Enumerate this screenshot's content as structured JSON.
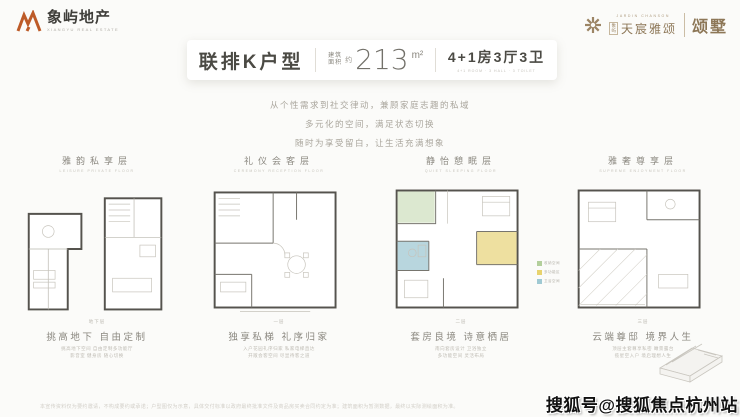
{
  "colors": {
    "brand_orange": "#bd5b28",
    "brand_gold": "#9c8565",
    "legend_green": "#b3cf9c",
    "legend_yellow": "#e8d36e",
    "legend_cyan": "#9fc9d3"
  },
  "header": {
    "left_brand": "象屿地产",
    "left_brand_en": "XIANGYU REAL ESTATE",
    "right_project_en": "JARDIN CHANSON",
    "right_prefix_1": "象",
    "right_prefix_2": "屿",
    "right_project": "天宸雅颂",
    "right_suffix": "颂墅"
  },
  "title_card": {
    "type_label": "联排K户型",
    "area_label_1": "建筑",
    "area_label_2": "面积",
    "area_approx": "约",
    "area_value": "213",
    "area_unit": "m²",
    "rooms": "4+1房3厅3卫",
    "rooms_en": "4+1 ROOM · 3 HALL · 3 TOILET"
  },
  "intro": {
    "line1": "从个性需求到社交律动，兼顾家庭志趣的私域",
    "line2": "多元化的空间，满足状态切换",
    "line3": "随时为享受留白，让生活充满想象"
  },
  "plans": [
    {
      "label": "雅韵私享层",
      "label_en": "LEISURE PRIVATE FLOOR",
      "floor_tag": "地下层",
      "caption": "挑高地下 自由定制",
      "note1": "挑高地下空间 自由定制多功能厅",
      "note2": "影音室 健身房 随心切换"
    },
    {
      "label": "礼仪会客层",
      "label_en": "CEREMONY RECEPTION FLOOR",
      "floor_tag": "一层",
      "caption": "独享私梯 礼序归家",
      "note1": "入户花园礼序归家 私家电梯直达",
      "note2": "开敞会客空间 尽显待客之道"
    },
    {
      "label": "静怡憩眠层",
      "label_en": "QUIET SLEEPING FLOOR",
      "floor_tag": "二层",
      "caption": "套房良境 诗意栖居",
      "note1": "南向套房设计 卫浴独立",
      "note2": "多功能空间 灵活布局"
    },
    {
      "label": "雅奢尊享层",
      "label_en": "SUPREME ENJOYMENT FLOOR",
      "floor_tag": "三层",
      "caption": "云端尊邸 境界人生",
      "note1": "顶层主套尊享私密 瞰景露台",
      "note2": "揽星空入户 境启理想人生"
    }
  ],
  "legend": {
    "items": [
      {
        "label": "收纳空间",
        "color": "#b3cf9c"
      },
      {
        "label": "多功能区",
        "color": "#e8d36e"
      },
      {
        "label": "卫浴空间",
        "color": "#9fc9d3"
      }
    ]
  },
  "watermark": "搜狐号@搜狐焦点杭州站",
  "disclaimer": "本宣传资料仅为要约邀请，不构成要约或承诺；户型图仅为示意，具体交付标准以政府最终批准文件及商品房买卖合同约定为准；建筑面积为暂测数据，最终以实际测绘面积为准。"
}
